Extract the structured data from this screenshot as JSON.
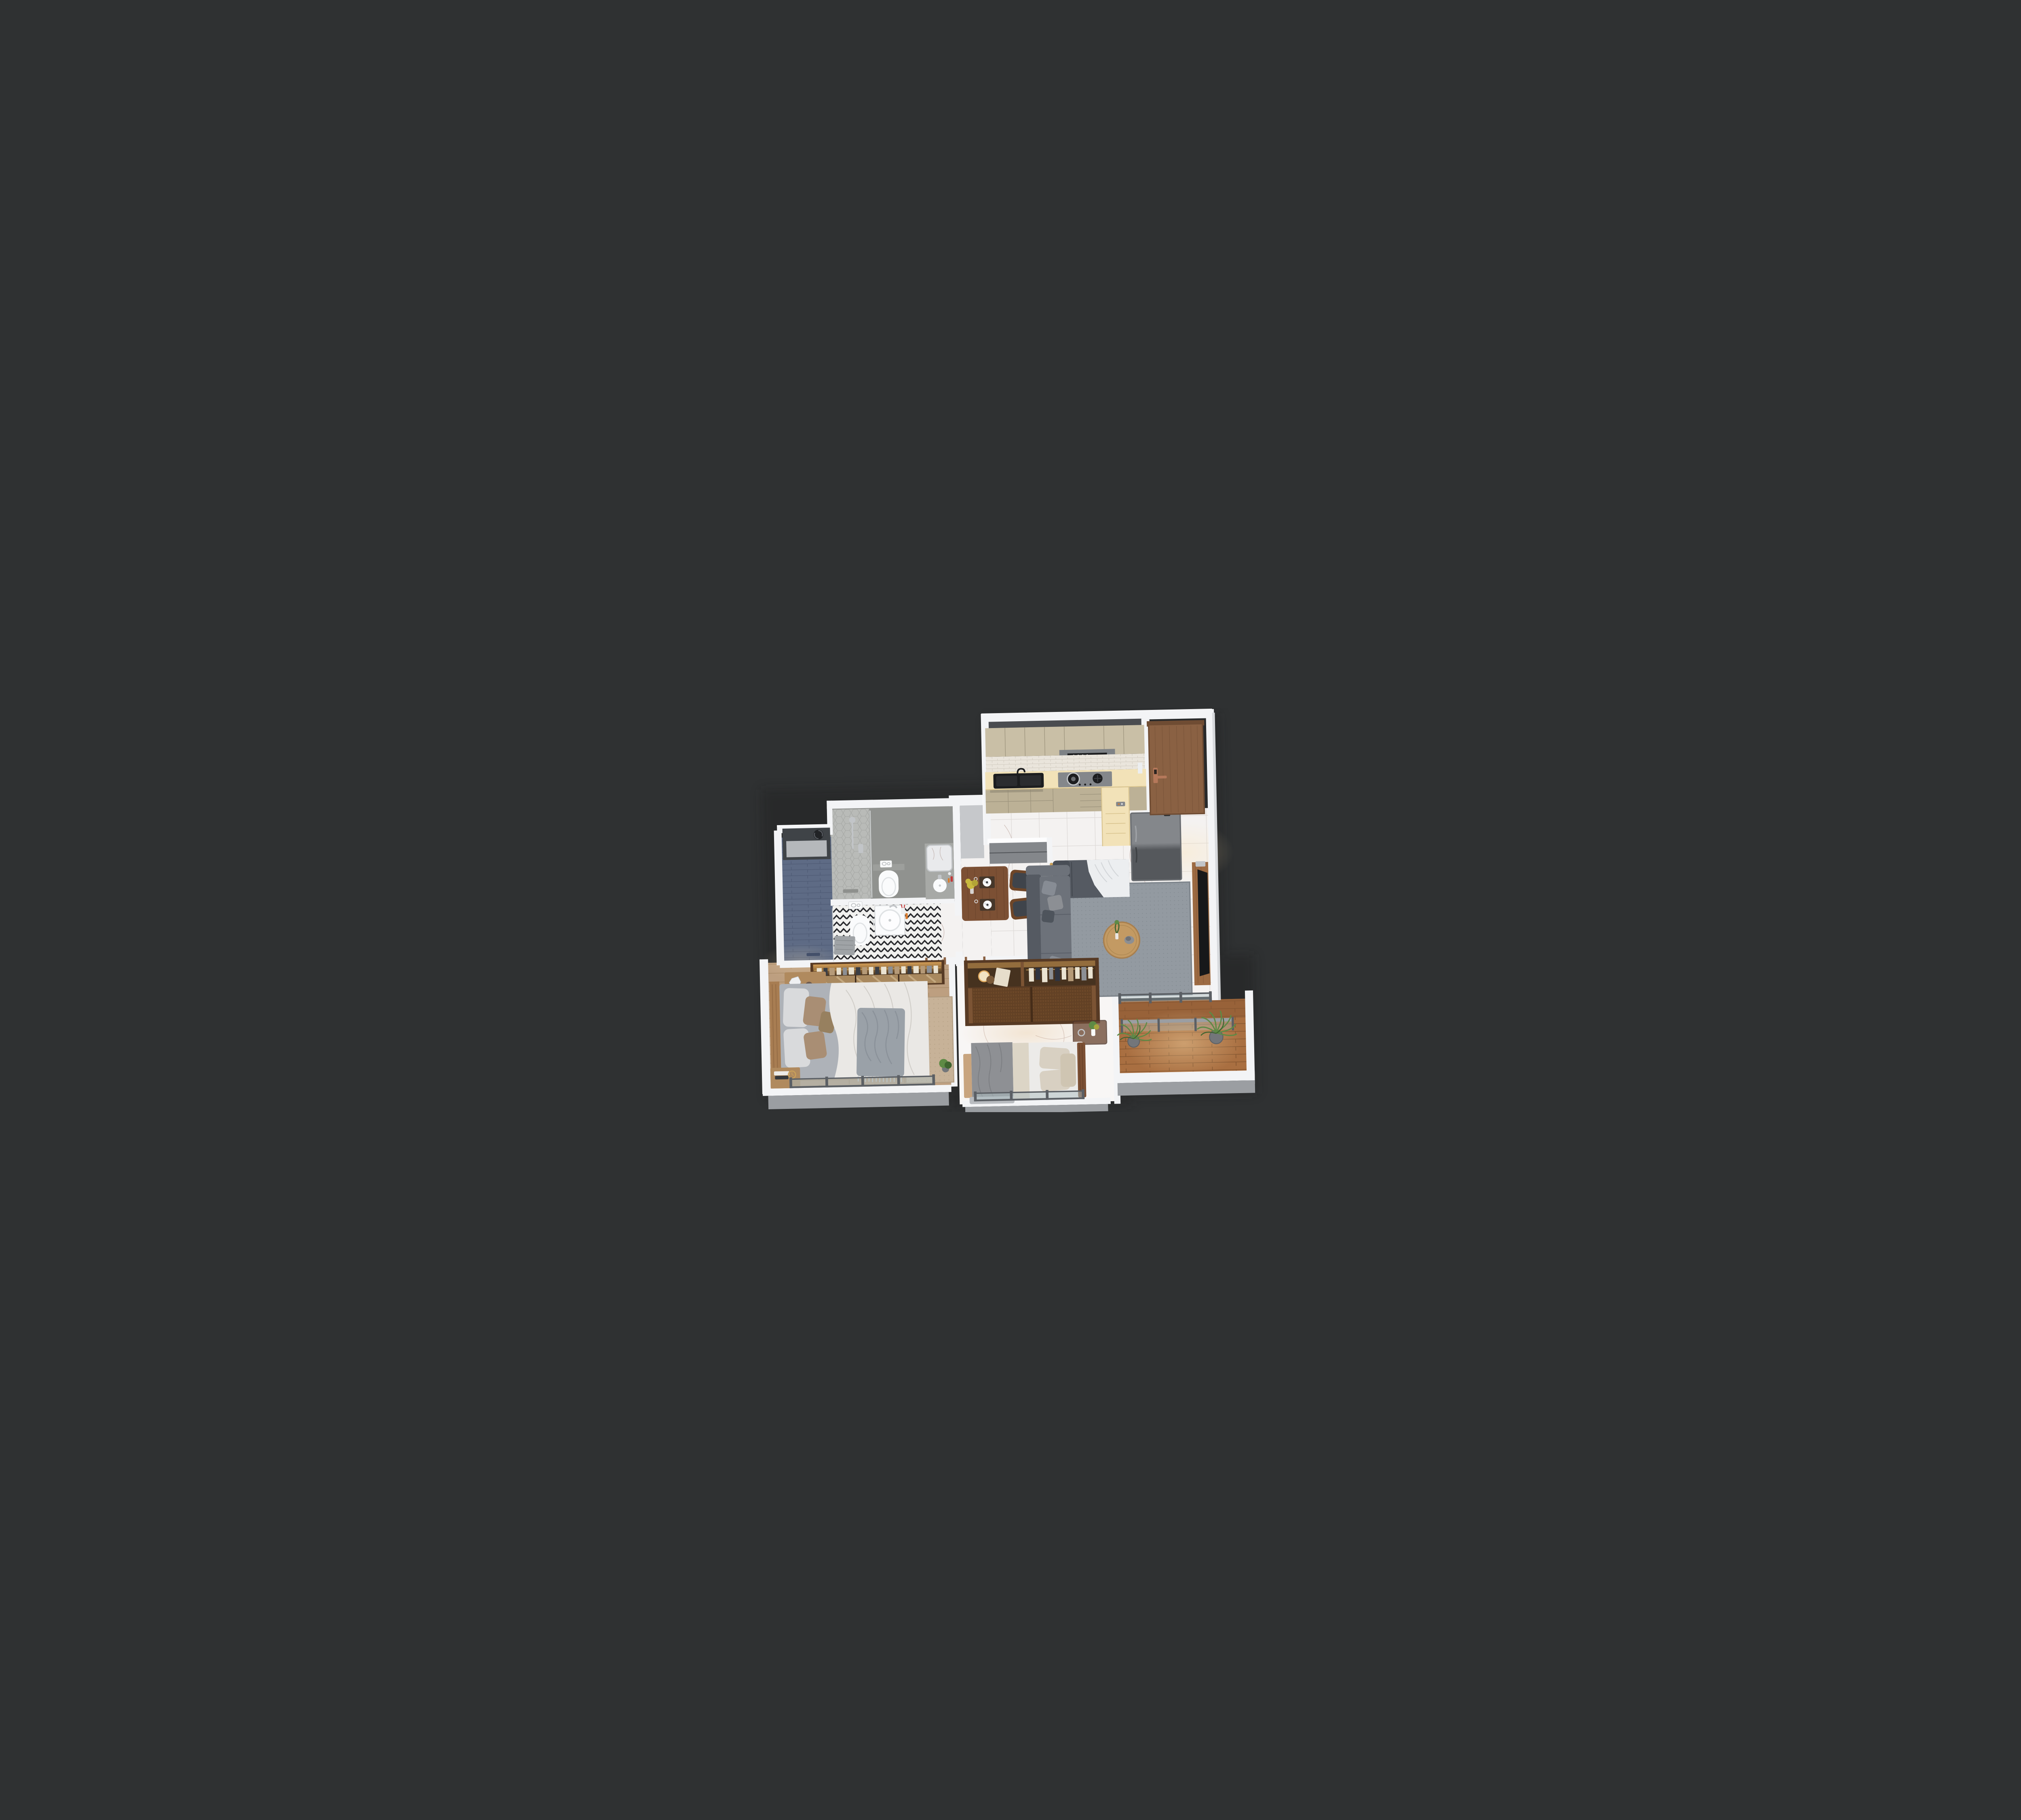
{
  "scene": {
    "type": "3d-apartment-floor-plan-render",
    "view": "isometric-top-down-cutaway",
    "rooms": [
      {
        "id": "kitchen",
        "name": "kitchen",
        "floor": "marble",
        "features": [
          "upper-cabinets",
          "range-hood",
          "hood-indicator-lights",
          "white-brick-backsplash",
          "cream-countertop",
          "black-double-sink",
          "gas-hob",
          "cooking-pot",
          "lower-cabinets",
          "counter-return",
          "fridge",
          "fridge-plant"
        ]
      },
      {
        "id": "entry",
        "name": "entrance-hall",
        "floor": "marble",
        "features": [
          "wood-entry-door",
          "copper-smart-lock"
        ]
      },
      {
        "id": "living",
        "name": "living-room",
        "floor": "marble",
        "features": [
          "gray-sectional-sofa",
          "throw-pillows",
          "daybed-chaise",
          "white-throw-blanket",
          "floor-lamp",
          "gray-area-rug",
          "round-coffee-table",
          "table-plant",
          "hat",
          "tv-wood-panel",
          "tv",
          "soundbar"
        ]
      },
      {
        "id": "dining",
        "name": "dining-area",
        "floor": "marble",
        "features": [
          "walnut-table",
          "yellow-flower-vase",
          "two-place-settings",
          "wine-glasses",
          "two-wood-chairs",
          "gray-peninsula-cabinet"
        ]
      },
      {
        "id": "bath-a",
        "name": "bathroom-1",
        "floor": "gray-tile",
        "features": [
          "hex-tile-shower",
          "shower-fixture",
          "glass-screen",
          "wall-hung-toilet",
          "flush-plate",
          "vanity-counter",
          "round-basin",
          "mirror",
          "toiletries"
        ]
      },
      {
        "id": "bath-b",
        "name": "bathroom-2",
        "floor": "black-white-chevron-tile",
        "features": [
          "blue-plank-tile-shower",
          "frosted-window",
          "exhaust-fan",
          "wall-hung-toilet",
          "flush-plate",
          "square-basin",
          "toothbrush-cup",
          "bath-mat"
        ]
      },
      {
        "id": "master",
        "name": "master-bedroom",
        "floor": "wood-plank",
        "features": [
          "lit-open-wardrobe",
          "hanging-clothes",
          "mirrored-sliders",
          "wood-nightstand",
          "head-sculpture",
          "vase",
          "books",
          "gold-ring-decor",
          "double-bed",
          "white-duvet",
          "taupe-pillows",
          "gray-fringe-throw",
          "beige-rug",
          "gold-clock",
          "corner-plant",
          "glass-window-railing"
        ]
      },
      {
        "id": "bedroom2",
        "name": "bedroom-2",
        "floor": "marble",
        "features": [
          "rattan-sliding-wardrobe",
          "wardrobe-lamp",
          "leaning-board",
          "hanging-clothes",
          "double-bed",
          "gray-blanket",
          "beige-pillows",
          "wood-headboard",
          "foot-cabinet",
          "glass-top-nightstand",
          "nightstand-plant",
          "alarm-clock",
          "glass-window-railing"
        ]
      },
      {
        "id": "balcony",
        "name": "balcony",
        "floor": "wood-deck",
        "features": [
          "glass-partition-wall",
          "glass-balustrade",
          "two-potted-palms",
          "white-parapet",
          "sunlight"
        ]
      },
      {
        "id": "hallway",
        "name": "hallway",
        "floor": "marble",
        "features": [
          "bedroom-door-openings",
          "wood-door-jambs"
        ]
      }
    ]
  },
  "palette": {
    "bg": "#2f3132",
    "shadow": "#1d1e1f",
    "wallWhite": "#f3f4f6",
    "wallBright": "#fdfdfe",
    "wallShade": "#d7d9dc",
    "wallTopDark": "#4a4c50",
    "grayWallFace": "#c6c8cb",
    "ledgeGray": "#9b9ea2",
    "ledgeLight": "#cbcdd0",
    "marble": "#f4f2f1",
    "marbleBright": "#f8f6f5",
    "marbleVein": "#a98a80",
    "marbleLine": "#ddd9d7",
    "woodFloor": "#bd9f80",
    "woodFloorDark": "#a1835f",
    "deck": "#a96f41",
    "deckDark": "#8a5833",
    "deckLine": "#7c4f2c",
    "cabinet": "#c9bfa6",
    "cabinetLow": "#bcb196",
    "cabinetSeam": "#9d947d",
    "counter": "#f2e2b8",
    "counterEdge": "#d9c48f",
    "backsplash": "#eae5dc",
    "brickLine": "#d2ccc1",
    "hood": "#7e8286",
    "applianceGray": "#84878b",
    "applianceDark": "#55585c",
    "black": "#1c1d1f",
    "steel": "#c2c5c8",
    "doorWood": "#8a6143",
    "doorWoodDark": "#6f4c33",
    "copper": "#b5785a",
    "sofa": "#6d727a",
    "sofaDark": "#555a62",
    "sofaLight": "#878c94",
    "throwWhite": "#eceef0",
    "rug": "#939aa1",
    "rugDark": "#7e858c",
    "rugBeige": "#c7b298",
    "rugBeigeDark": "#b29d82",
    "tableWood": "#7c5034",
    "chairWood": "#6f4628",
    "seatDark": "#3f444b",
    "coffeeWood": "#c39a63",
    "tvPanel": "#9c6a42",
    "tvBlack": "#17181a",
    "porcelain": "#fafbfc",
    "porcelainShade": "#dfe2e4",
    "tileGray": "#90928f",
    "tileWall": "#9d9f9c",
    "hexTile": "#b9bbb8",
    "hexLine": "#a3a5a2",
    "showerBlue": "#5e6b85",
    "showerBlueLine": "#4d5972",
    "chevWhite": "#f1f1ef",
    "chevBlack": "#26272b",
    "glass": "#aebfc4",
    "railFrame": "#5b5f64",
    "plant": "#5e8a45",
    "plantDark": "#3f6530",
    "pot": "#73767a",
    "duvet": "#eae8e5",
    "duvetFold": "#cfccc7",
    "mattress": "#aeb2b8",
    "blanketGray": "#9aa1a8",
    "pillowTaupe": "#a98e74",
    "pillowBeige": "#d8d0c2",
    "pillowWhite": "#d9dadc",
    "bedGray": "#8e9094",
    "sheetWhite": "#ecebe9",
    "wardrobe": "#7c5434",
    "wardrobeDark": "#573a24",
    "wardrobeInner": "#46321f",
    "weave": "#6b4728",
    "weaveLine": "#50341d",
    "mirrorWood": "#a9895f",
    "mirrorWoodHi": "#cbb189",
    "glow": "#e0a85c",
    "gold": "#c9a05a",
    "clothesLight": "#eae3d2",
    "clothesDark": "#3b3e44",
    "clothesTan": "#b59a78",
    "clothesGray": "#8c8f94",
    "navy": "#2f3440",
    "sun": "#ffe3b0",
    "flowerYellow": "#c9b93f"
  }
}
